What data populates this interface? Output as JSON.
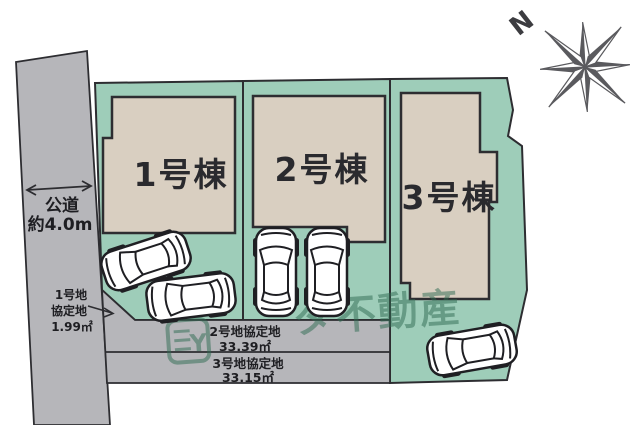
{
  "road": {
    "type_label": "公道",
    "width_label": "約4.0m"
  },
  "compass": {
    "north_label": "N"
  },
  "buildings": [
    {
      "label": "1号棟"
    },
    {
      "label": "2号棟"
    },
    {
      "label": "3号棟"
    }
  ],
  "agreement_areas": [
    {
      "name_line1": "1号地",
      "name_line2": "協定地",
      "area": "1.99㎡"
    },
    {
      "name": "2号地協定地",
      "area": "33.39㎡"
    },
    {
      "name": "3号地協定地",
      "area": "33.15㎡"
    }
  ],
  "watermark": {
    "logo_letter": "Y",
    "brand_text": "ダ不動産"
  },
  "colors": {
    "lot_green": "#9ecdb9",
    "building_beige": "#d9cfc1",
    "road_gray": "#b6b6ba",
    "outline_dark": "#2d2d31",
    "watermark_green": "#2f6b52"
  }
}
